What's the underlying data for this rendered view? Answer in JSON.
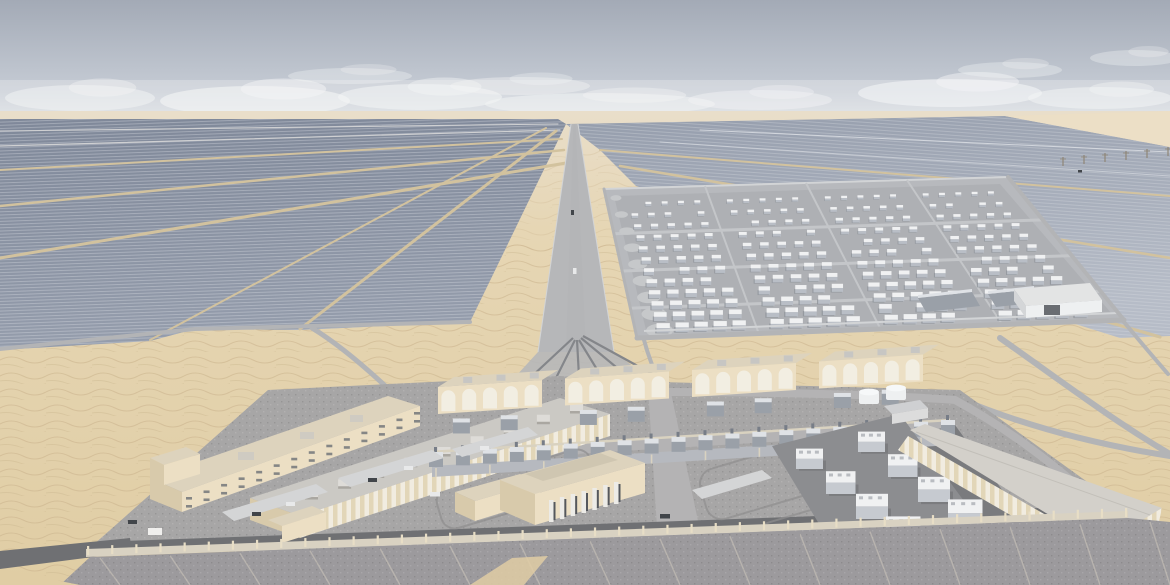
{
  "scene": {
    "description": "Aerial 3D architectural rendering of a desert solar photovoltaic plant with a battery energy storage yard and an operations facility compound in the foreground",
    "sky": {
      "clouds": [
        {
          "cx": 80,
          "cy": 98,
          "rx": 75,
          "ry": 13,
          "o": 0.5
        },
        {
          "cx": 255,
          "cy": 101,
          "rx": 95,
          "ry": 15,
          "o": 0.62
        },
        {
          "cx": 420,
          "cy": 97,
          "rx": 82,
          "ry": 13,
          "o": 0.55
        },
        {
          "cx": 600,
          "cy": 104,
          "rx": 115,
          "ry": 11,
          "o": 0.5
        },
        {
          "cx": 760,
          "cy": 100,
          "rx": 72,
          "ry": 10,
          "o": 0.45
        },
        {
          "cx": 950,
          "cy": 93,
          "rx": 92,
          "ry": 14,
          "o": 0.6
        },
        {
          "cx": 1100,
          "cy": 98,
          "rx": 72,
          "ry": 11,
          "o": 0.52
        },
        {
          "cx": 1135,
          "cy": 58,
          "rx": 45,
          "ry": 8,
          "o": 0.35
        },
        {
          "cx": 350,
          "cy": 76,
          "rx": 62,
          "ry": 8,
          "o": 0.35
        },
        {
          "cx": 520,
          "cy": 86,
          "rx": 70,
          "ry": 9,
          "o": 0.4
        },
        {
          "cx": 1010,
          "cy": 70,
          "rx": 52,
          "ry": 8,
          "o": 0.35
        }
      ]
    },
    "battery_yard": {
      "rows": 12,
      "cols": 24,
      "lane_every": 6,
      "edge_pads": 9
    },
    "transmission_poles": 6,
    "facility": {
      "substation_bays": 4,
      "arches_per_bay": 5,
      "switchgear_clusters": 20,
      "genset_units": 8,
      "wall_posts": 44,
      "apron_joints": 16,
      "admin_windows_per_row": 14,
      "roof_hvac_units": 9,
      "pump_stacks": 7
    }
  },
  "colors": {
    "sky_top": "#a3aab6",
    "sky_mid": "#c6ccd5",
    "sky_horizon": "#e4e7ea",
    "cloud": "#f4f5f6",
    "sand_far": "#e9deca",
    "sand_mid": "#e6d6b4",
    "sand_near": "#e0cda4",
    "sand_ripple": "#c9b38c",
    "sand_wedge": "#ecdfc6",
    "panel_dark": "#7f8899",
    "panel_mid": "#959dac",
    "panel_light": "#b6bcc7",
    "panel_line": "#dfe2e7",
    "field_road_tan": "#d2c29e",
    "field_road_gray": "#cfd0d2",
    "road_gray": "#b3b4b6",
    "road_dark": "#84868a",
    "corridor_road": "#b6b7b9",
    "yard_base": "#b7b9bd",
    "yard_inner": "#aeb0b4",
    "yard_lane": "#c4c6c9",
    "yard_rim": "#d2d4d6",
    "unit_top": "#f0f1f2",
    "unit_front": "#b9bec6",
    "unit_shadow": "#8f939a",
    "edge_pad": "#c6c8ca",
    "concrete": "#a7a6a6",
    "gravel_dark": "#8c8d90",
    "asphalt": "#6f7073",
    "asphalt_mid": "#7a7b7e",
    "road_smooth": "#b4b3b4",
    "kerb": "#8f8e8f",
    "beige_light": "#ecdfc4",
    "beige_roof": "#ddd3bd",
    "beige_side": "#d8caab",
    "beige_stripe": "#e2d6b8",
    "white_stripe": "#f1ece0",
    "roof_gray": "#cbc9c4",
    "roof_warehouse": "#d3d0ca",
    "window_dark": "#6b6f76",
    "arch_white": "#f2eee2",
    "machine_gray": "#9aa0a8",
    "machine_light": "#dfe2e6",
    "rack_beam": "#d9d2c0",
    "wall_band": "#d9d2c2",
    "wall_post": "#e8dec6",
    "apron": "#9c9a9d",
    "apron_joint": "#cfc9bd",
    "tank_white": "#eef0f1",
    "door_dark": "#6a6d72",
    "car_dark": "#41454a",
    "car_white": "#e8e9ea",
    "pole": "#8f8676"
  }
}
